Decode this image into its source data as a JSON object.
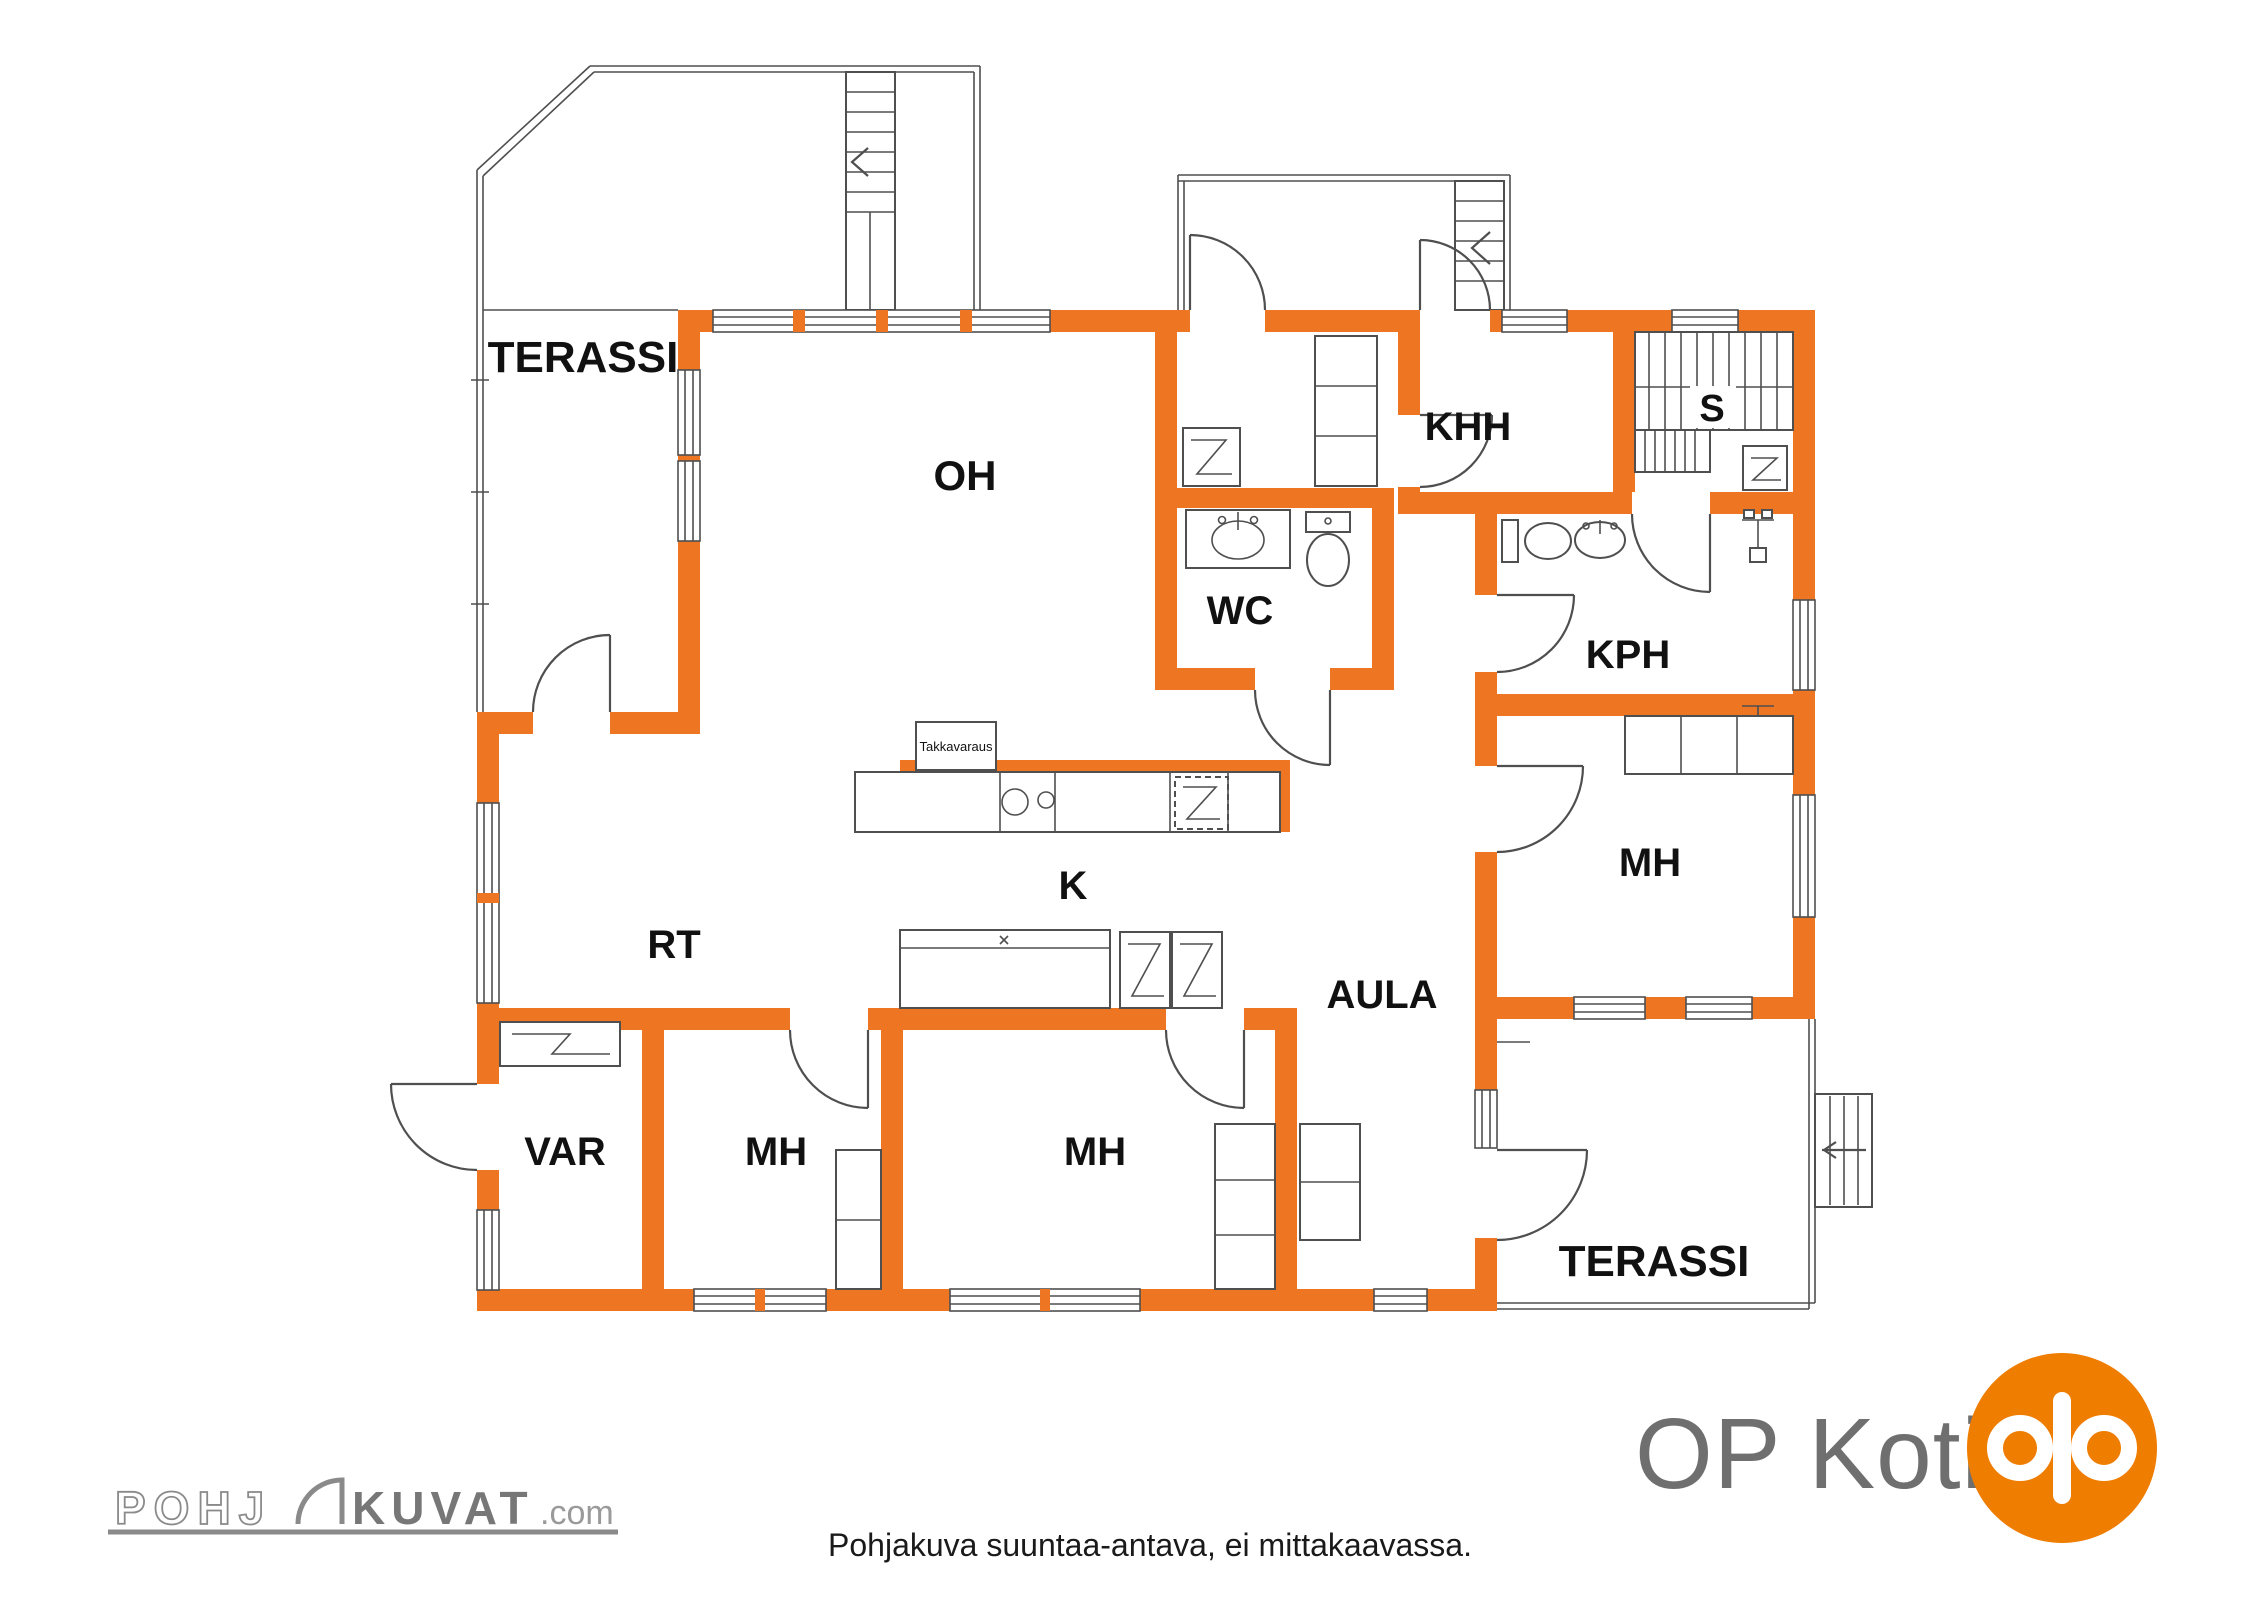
{
  "colors": {
    "wall_orange": "#EE7623",
    "line_gray": "#4F4F4F",
    "label_black": "#111111",
    "logo_gray": "#8A8A8A",
    "op_text_gray": "#6F6F6F",
    "op_orange": "#EF7D00"
  },
  "rooms": {
    "terassi_nw": "TERASSI",
    "oh": "OH",
    "khh": "KHH",
    "sauna": "S",
    "wc": "WC",
    "kph": "KPH",
    "rt": "RT",
    "kitchen": "K",
    "aula": "AULA",
    "mh_right": "MH",
    "mh_sw": "MH",
    "mh_south": "MH",
    "var": "VAR",
    "terassi_se": "TERASSI"
  },
  "annotations": {
    "takkavaraus": "Takkavaraus"
  },
  "footer": {
    "disclaimer": "Pohjakuva suuntaa-antava, ei mittakaavassa."
  },
  "logos": {
    "pohjakuvat": {
      "prefix": "POHJ",
      "main": "KUVAT",
      "suffix": ".com"
    },
    "op": {
      "wordmark": "OP Koti"
    }
  }
}
